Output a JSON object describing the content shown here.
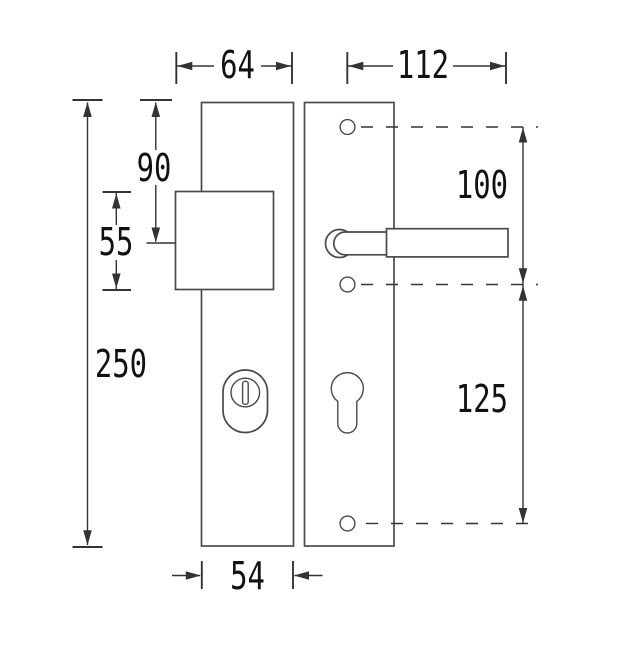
{
  "drawing": {
    "type": "technical-dimension-drawing",
    "subject": "security-door-handle-fitting-front-view",
    "colors": {
      "background": "#ffffff",
      "line": "#4a4a4a",
      "dim": "#333333",
      "text": "#111111"
    },
    "dimensions": {
      "top_width": "64",
      "handle_length": "112",
      "knob_center_from_top": "90",
      "knob_height": "55",
      "plate_height": "250",
      "hole_spacing_upper": "100",
      "hole_spacing_lower": "125",
      "plate_width": "54"
    }
  }
}
